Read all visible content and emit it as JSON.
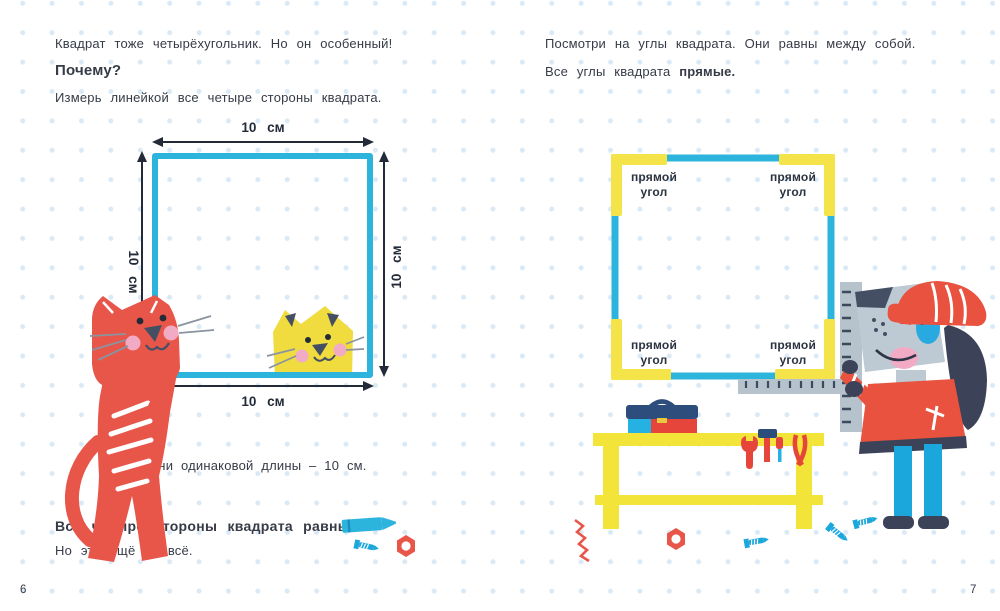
{
  "left_page": {
    "page_number": "6",
    "intro": "Квадрат тоже четырёхугольник. Но он особенный!",
    "question": "Почему?",
    "instruction": "Измерь линейкой все четыре стороны квадрата.",
    "dimension_labels": {
      "top": "10 см",
      "left": "10 см",
      "right": "10 см",
      "bottom": "10 см"
    },
    "caption": "Они одинаковой длины – 10 см.",
    "conclusion": "Все четыре стороны квадрата равны.",
    "footnote": "Но это ещё не всё."
  },
  "right_page": {
    "page_number": "7",
    "intro": "Посмотри на углы квадрата. Они равны между собой.",
    "statement_prefix": "Все углы квадрата",
    "statement_bold": "прямые.",
    "corner_label_line1": "прямой",
    "corner_label_line2": "угол"
  },
  "colors": {
    "cyan": "#2db4dd",
    "corner_yellow": "#f5e34a",
    "red": "#e8564a",
    "navy": "#3c4258",
    "blue": "#1ba6dc",
    "pink": "#f2abc4",
    "dog_gray": "#bdc9d3",
    "ruler_gray": "#b6c3cd",
    "bench_yellow": "#f2e438",
    "text": "#363b47",
    "dot_grid": "#d9e9f6"
  }
}
